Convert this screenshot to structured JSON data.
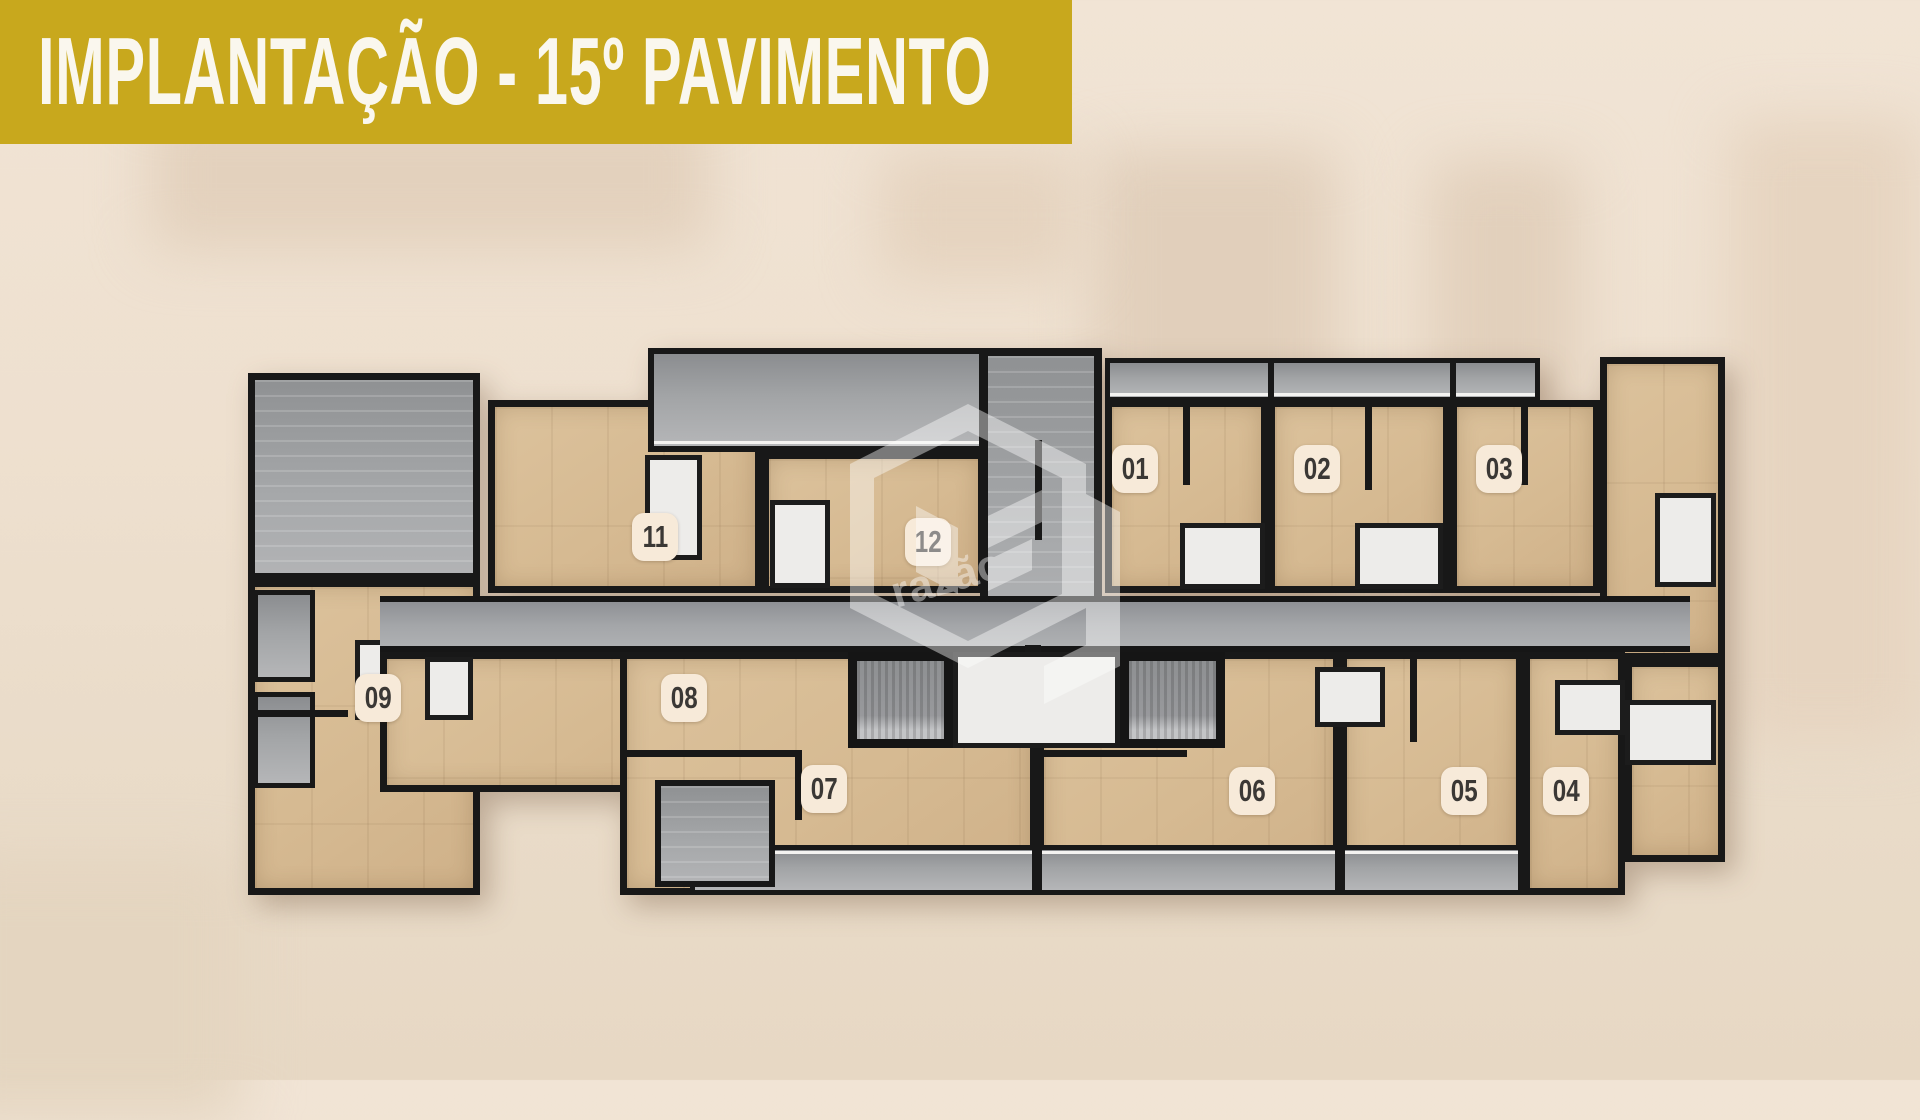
{
  "banner": {
    "title": "IMPLANTAÇÃO - 15º PAVIMENTO"
  },
  "watermark": {
    "text": "razão"
  },
  "plan": {
    "units": [
      {
        "label": "01"
      },
      {
        "label": "02"
      },
      {
        "label": "03"
      },
      {
        "label": "04"
      },
      {
        "label": "05"
      },
      {
        "label": "06"
      },
      {
        "label": "07"
      },
      {
        "label": "08"
      },
      {
        "label": "09"
      },
      {
        "label": "11"
      },
      {
        "label": "12"
      }
    ]
  },
  "colors": {
    "banner_gold": "#c8a81d",
    "banner_text": "#faf7ee",
    "wood_floor": "#d6ba92",
    "balcony_gray": "#a2a4a6",
    "wall_black": "#181818",
    "room_white": "#edecea",
    "badge_bg": "#f7ead9",
    "badge_text": "#3b3835",
    "background_beige": "#ecdecb"
  }
}
